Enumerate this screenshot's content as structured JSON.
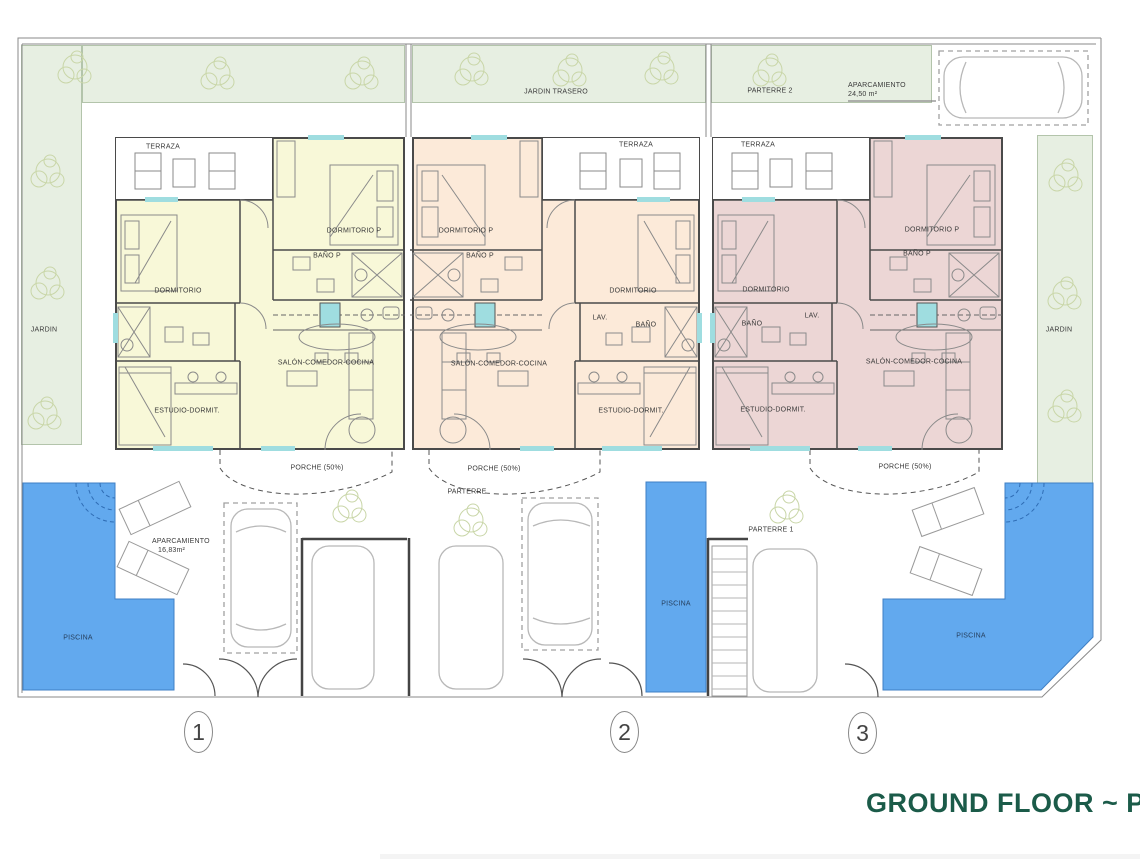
{
  "title": "GROUND FLOOR ~ PLANTA",
  "site": {
    "jardin_trasero": "JARDIN TRASERO",
    "parterre_2": "PARTERRE 2",
    "jardin_left": "JARDIN",
    "jardin_right": "JARDIN",
    "aparcamiento_top_label": "APARCAMIENTO",
    "aparcamiento_top_area": "24,50 m²"
  },
  "units": [
    {
      "number": "1",
      "rooms": {
        "terraza": "TERRAZA",
        "dormitorio_p": "DORMITORIO P",
        "bano_p": "BAÑO P",
        "dormitorio": "DORMITORIO",
        "salon": "SALÓN-COMEDOR-COCINA",
        "estudio": "ESTUDIO-DORMIT.",
        "porche": "PORCHE (50%)"
      },
      "exterior": {
        "piscina": "PISCINA",
        "aparcamiento_label": "APARCAMIENTO",
        "aparcamiento_area": "16,83m²"
      }
    },
    {
      "number": "2",
      "rooms": {
        "terraza": "TERRAZA",
        "dormitorio_p": "DORMITORIO P",
        "bano_p": "BAÑO P",
        "dormitorio": "DORMITORIO",
        "lav": "LAV.",
        "bano": "BAÑO",
        "salon": "SALÓN-COMEDOR-COCINA",
        "estudio": "ESTUDIO-DORMIT.",
        "porche": "PORCHE (50%)"
      },
      "exterior": {
        "piscina": "PISCINA",
        "parterre": "PARTERRE"
      }
    },
    {
      "number": "3",
      "rooms": {
        "terraza": "TERRAZA",
        "dormitorio_p": "DORMITORIO P",
        "bano_p": "BAÑO P",
        "dormitorio": "DORMITORIO",
        "lav": "LAV.",
        "bano": "BAÑO",
        "salon": "SALÓN-COMEDOR-COCINA",
        "estudio": "ESTUDIO-DORMIT.",
        "porche": "PORCHE (50%)"
      },
      "exterior": {
        "piscina": "PISCINA",
        "parterre": "PARTERRE 1"
      }
    }
  ],
  "colors": {
    "unit1": "#f8f8d8",
    "unit2": "#fcead9",
    "unit3": "#ecd6d5",
    "garden": "#e7efe2",
    "pool": "#62a9ee",
    "teal": "#9fdde0",
    "title_green": "#1b5b49"
  }
}
